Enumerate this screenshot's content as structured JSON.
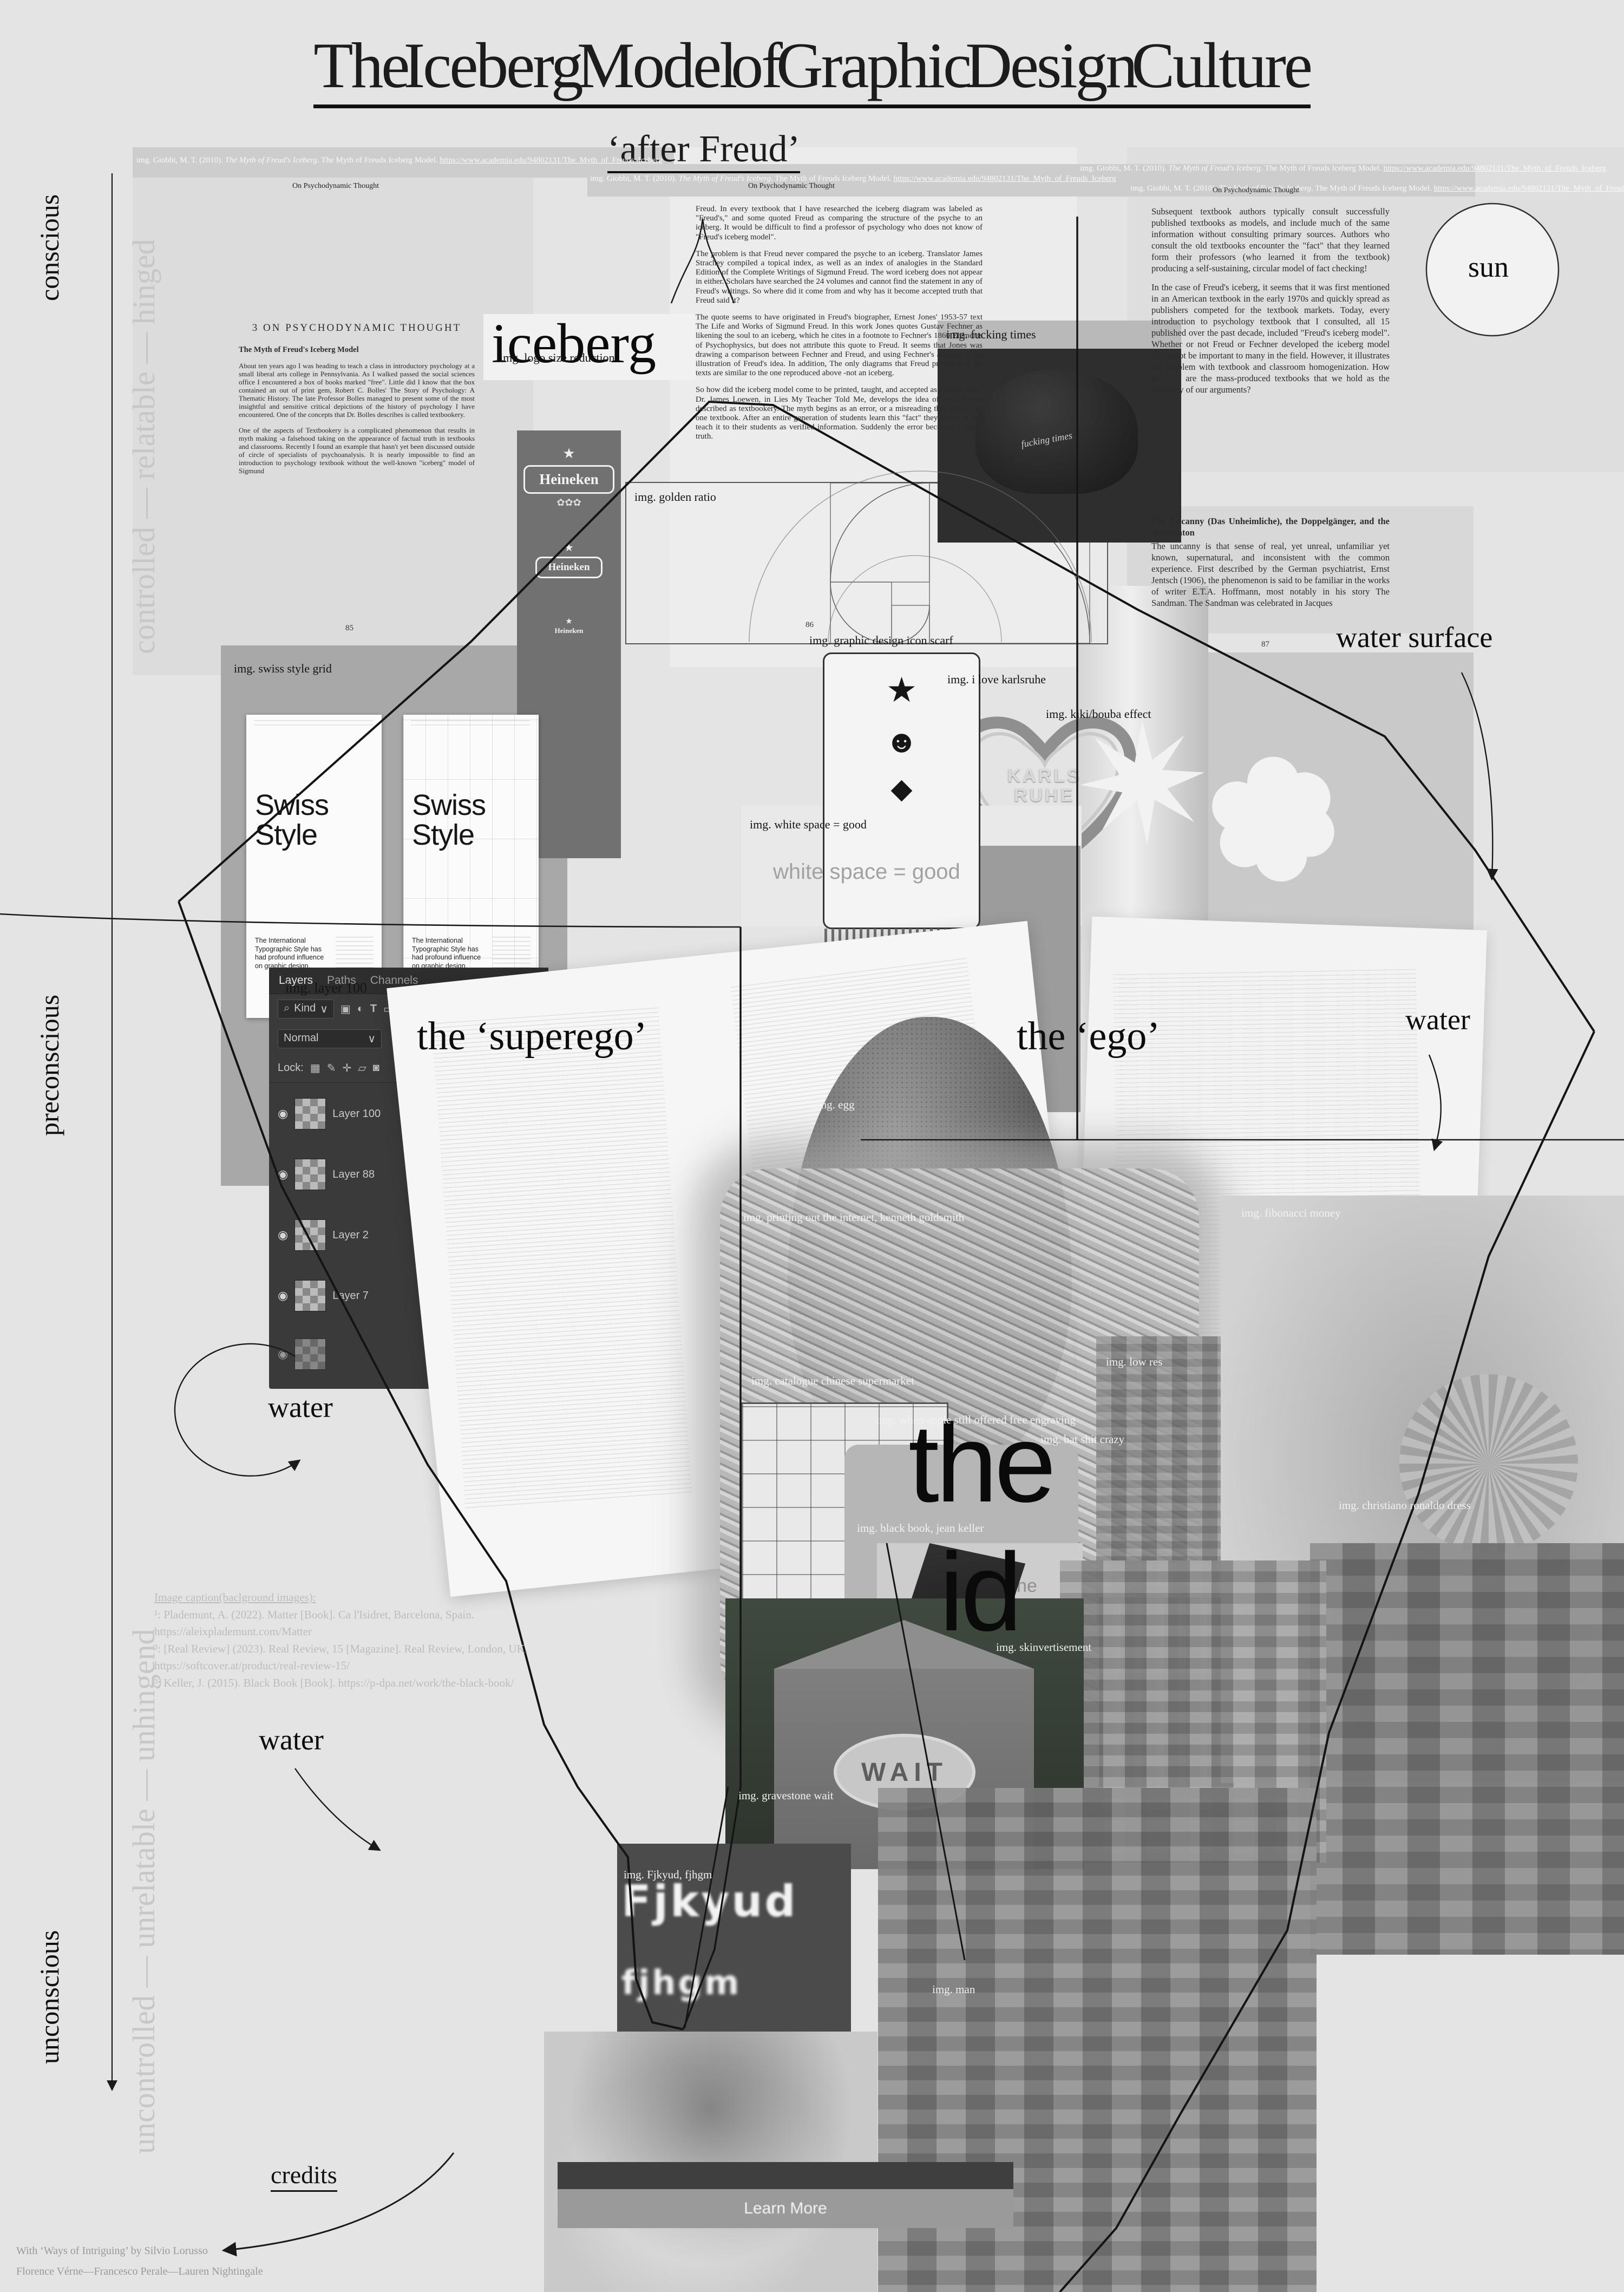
{
  "header": {
    "title": "The Iceberg Model of Graphic Design Culture",
    "subtitle": "‘after Freud’",
    "citation": {
      "prefix": "img. Giobbi, M. T. (2010). ",
      "work": "The Myth of Freud's Iceberg",
      "middle": ". The Myth of Freuds Iceberg Model. ",
      "url": "https://www.academia.edu/94802131/The_Myth_of_Freuds_Iceberg"
    },
    "column_header": "On Psychodynamic Thought"
  },
  "axis": {
    "conscious": "conscious",
    "preconscious": "preconscious",
    "unconscious": "unconscious",
    "controlled": "controlled — relatable — hinged",
    "uncontrolled": "uncontrolled — unrelatable — unhingend"
  },
  "labels": {
    "iceberg": "iceberg",
    "sun": "sun",
    "water_surface": "water surface",
    "water": "water",
    "superego": "the ‘superego’",
    "ego": "the ‘ego’",
    "id_the": "the",
    "id": "id",
    "credits": "credits"
  },
  "article": {
    "section": "3 ON PSYCHODYNAMIC THOUGHT",
    "subhead": "The Myth of Freud's Iceberg Model",
    "col1_p1": "About ten years ago I was heading to teach a class in introductory psychology at a small liberal arts college in Pennsylvania. As I walked passed the social sciences office I encountered a box of books marked \"free\". Little did I know that the box contained an out of print gem, Robert C. Bolles' The Story of Psychology: A Thematic History. The late Professor Bolles managed to present some of the most insightful and sensitive critical depictions of the history of psychology I have encountered. One of the concepts that Dr. Bolles describes is called textbookery.",
    "col1_p2": "One of the aspects of Textbookery is a complicated phenomenon that results in myth making -a falsehood taking on the appearance of factual truth in textbooks and classrooms. Recently I found an example that hasn't yet been discussed outside of circle of specialists of psychoanalysis. It is nearly impossible to find an introduction to psychology textbook without the well-known \"iceberg\" model of Sigmund",
    "col2_p1": "Freud. In every textbook that I have researched the iceberg diagram was labeled as \"Freud's,\" and some quoted Freud as comparing the structure of the psyche to an iceberg. It would be difficult to find a professor of psychology who does not know of \"Freud's iceberg model\".",
    "col2_p2": "The problem is that Freud never compared the psyche to an iceberg. Translator James Strachey compiled a topical index, as well as an index of analogies in the Standard Edition of the Complete Writings of Sigmund Freud. The word iceberg does not appear in either. Scholars have searched the 24 volumes and cannot find the statement in any of Freud's writings. So where did it come from and why has it become accepted truth that Freud said it?",
    "col2_p3": "The quote seems to have originated in Freud's biographer, Ernest Jones' 1953-57 text The Life and Works of Sigmund Freud. In this work Jones quotes Gustav Fechner as likening the soul to an iceberg, which he cites in a footnote to Fechner's 1860 Elements of Psychophysics, but does not attribute this quote to Freud. It seems that Jones was drawing a comparison between Fechner and Freud, and using Fechner's analogy as an illustration of Freud's idea. In addition, The only diagrams that Freud provided in his texts are similar to the one reproduced above -not an iceberg.",
    "col2_p4": "So how did the iceberg model come to be printed, taught, and accepted as Freud's own? Dr. James Loewen, in Lies My Teacher Told Me, develops the idea of what Bolles described as textbookery. The myth begins as an error, or a misreading that appears in one textbook. After an entire generation of students learn this \"fact\" they accept it and teach it to their students as verified information. Suddenly the error becomes a social truth.",
    "col3_p1": "Subsequent textbook authors typically consult successfully published textbooks as models, and include much of the same information without consulting primary sources. Authors who consult the old textbooks encounter the \"fact\" that they learned form their professors (who learned it from the textbook) producing a self-sustaining, circular model of fact checking!",
    "col3_p2": "In the case of Freud's iceberg, it seems that it was first mentioned in an American textbook in the early 1970s and quickly spread as publishers competed for the textbook markets. Today, every introduction to psychology textbook that I consulted, all 15 published over the past decade, included \"Freud's iceberg model\". Whether or not Freud or Fechner developed the iceberg model might not be important to many in the field. However, it illustrates the problem with textbook and classroom homogenization. How accurate are the mass-produced textbooks that we hold as the authority of our arguments?",
    "uncanny_head": "The Uncanny (Das Unheimliche), the Doppelgänger, and the Automaton",
    "uncanny_p": "The uncanny is that sense of real, yet unreal, unfamiliar yet known, supernatural, and inconsistent with the common experience. First described by the German psychiatrist, Ernst Jentsch (1906), the phenomenon is said to be familiar in the works of writer E.T.A. Hoffmann, most notably in his story The Sandman. The Sandman was celebrated in Jacques",
    "page_85": "85",
    "page_86": "86",
    "page_87": "87"
  },
  "img_labels": {
    "logo_size": "img. logo size reduction",
    "golden_ratio": "img. golden ratio",
    "fucking_times": "img. fucking times",
    "karlsruhe": "img. i love karlsruhe",
    "swiss_grid": "img. swiss style grid",
    "white_space": "img. white space = good",
    "scarf": "img. graphic design icon scarf",
    "kiki_bouba": "img. kiki/bouba effect",
    "layer_100": "img. layer 100",
    "egg": "img. egg",
    "printing": "img. printing out the internet, kenneth goldsmith",
    "low_res": "img. low res",
    "supermarket": "img. catalogue chinese supermarket",
    "apple": "img. when apple still offered free engraving",
    "bat": "img. bat shit crazy",
    "fibonacci": "img. fibonacci money",
    "ronaldo": "img. christiano ronaldo dress",
    "black_book": "img. black book, jean keller",
    "skinvertisement": "img. skinvertisement",
    "gravestone": "img. gravestone wait",
    "glitch": "img. Fjkyud, fjhgm",
    "man": "img. man"
  },
  "figures": {
    "white_space_text": "white space = good",
    "heineken": {
      "name": "Heineken",
      "star": "★"
    },
    "cap_text": "fucking times",
    "karlsruhe_heart": "KARLS RUHE",
    "swiss_poster": {
      "title_line1": "Swiss",
      "title_line2": "Style",
      "body": "The International Typographic Style has had profound influence on graphic design."
    },
    "scarf_glyphs": [
      "★",
      "☻",
      "◆"
    ],
    "wait": "WAIT",
    "glitch_words": [
      "Fjkyud",
      "fjhgm"
    ],
    "learn_more": "Learn More",
    "iphone": {
      "name": "iPhone",
      "capacity": "4GB"
    }
  },
  "layers_panel": {
    "tabs": [
      "Layers",
      "Paths",
      "Channels"
    ],
    "menu_icon": "≡",
    "kind": "Kind",
    "blend_mode": "Normal",
    "opacity_label": "Opacity:",
    "opacity": "100%",
    "lock_label": "Lock:",
    "fill_label": "Fill:",
    "fill": "100%",
    "layers": [
      "Layer 100",
      "Layer 88",
      "Layer 2",
      "Layer 7"
    ]
  },
  "captions": {
    "heading": "Image caption(baclground images):",
    "item1": "¹: Plademunt, A. (2022). Matter [Book]. Ca l'Isidret, Barcelona, Spain. https://aleixplademunt.com/Matter",
    "item2": "²: [Real Review] (2023). Real Review, 15 [Magazine]. Real Review, London, UK. https://softcover.at/product/real-review-15/",
    "item3": "³: Keller, J. (2015). Black Book [Book]. https://p-dpa.net/work/the-black-book/"
  },
  "footer": {
    "line1": "With ‘Ways of Intriguing’ by Silvio Lorusso",
    "line2": "Florence Vérne—Francesco Perale—Lauren Nightingale"
  }
}
